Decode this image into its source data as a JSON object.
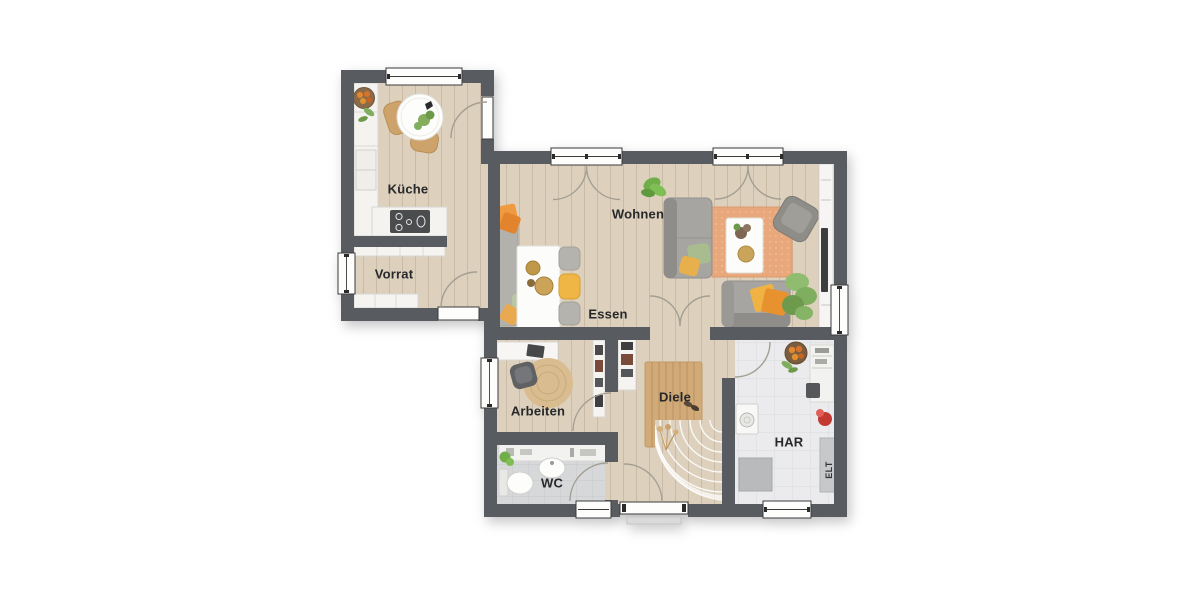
{
  "floorplan": {
    "rooms": {
      "kueche": {
        "label": "Küche"
      },
      "vorrat": {
        "label": "Vorrat"
      },
      "wohnen": {
        "label": "Wohnen"
      },
      "essen": {
        "label": "Essen"
      },
      "arbeiten": {
        "label": "Arbeiten"
      },
      "diele": {
        "label": "Diele"
      },
      "wc": {
        "label": "WC"
      },
      "har": {
        "label": "HAR"
      },
      "elt": {
        "label": "ELT"
      }
    },
    "colors": {
      "wall": "#585c60",
      "wood_floor": "#ddd1be",
      "wc_tile": "#d7d8da",
      "har_tile": "#ebebed",
      "living_rug": "#e8a87c",
      "accent_orange": "#ef9a3e",
      "accent_yellow": "#efb545",
      "plant_green": "#7fae5e",
      "furniture_white": "#f7f6f4",
      "sofa_gray": "#a7a5a1",
      "background": "#ffffff"
    }
  }
}
